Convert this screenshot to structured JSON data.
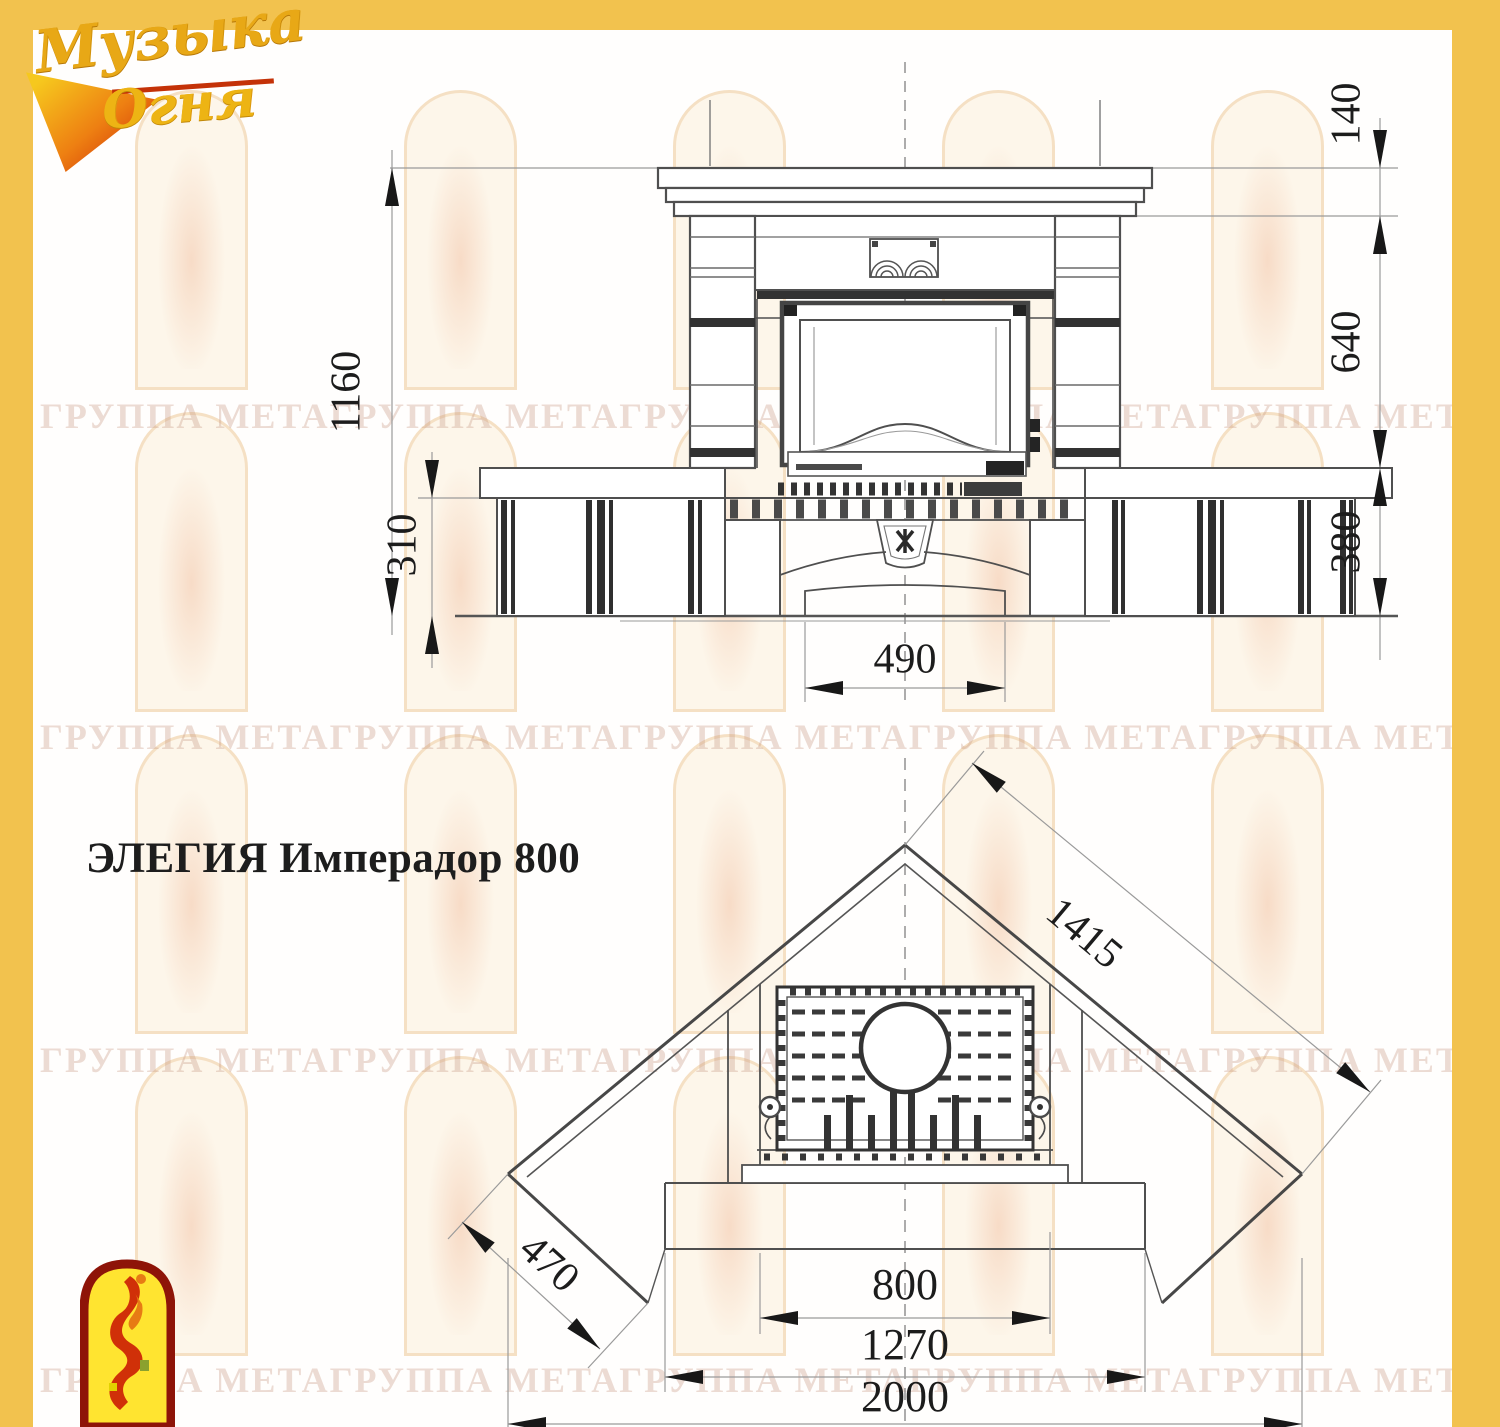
{
  "brand": {
    "logo_line1": "Музыка",
    "logo_line2": "Огня",
    "accent_gold": "#f2c24e",
    "accent_red": "#c43208"
  },
  "title": "ЭЛЕГИЯ Имперадор 800",
  "watermark_text": "ГРУППА МЕТАГРУППА МЕТАГРУППА МЕТАГРУППА МЕТАГРУППА МЕТАГРУППА МЕТА",
  "front_view": {
    "label": "front-elevation-drawing",
    "dims": {
      "total_height": "1160",
      "bench_base_height": "310",
      "pedestal_width": "490",
      "mantel_shelf_height": "140",
      "firebox_zone_height": "640",
      "bench_height": "380"
    }
  },
  "plan_view": {
    "label": "corner-plan-drawing",
    "dims": {
      "wall_diagonal": "1415",
      "side_return": "470",
      "insert_width": "800",
      "hearth_width": "1270",
      "total_width": "2000"
    }
  }
}
